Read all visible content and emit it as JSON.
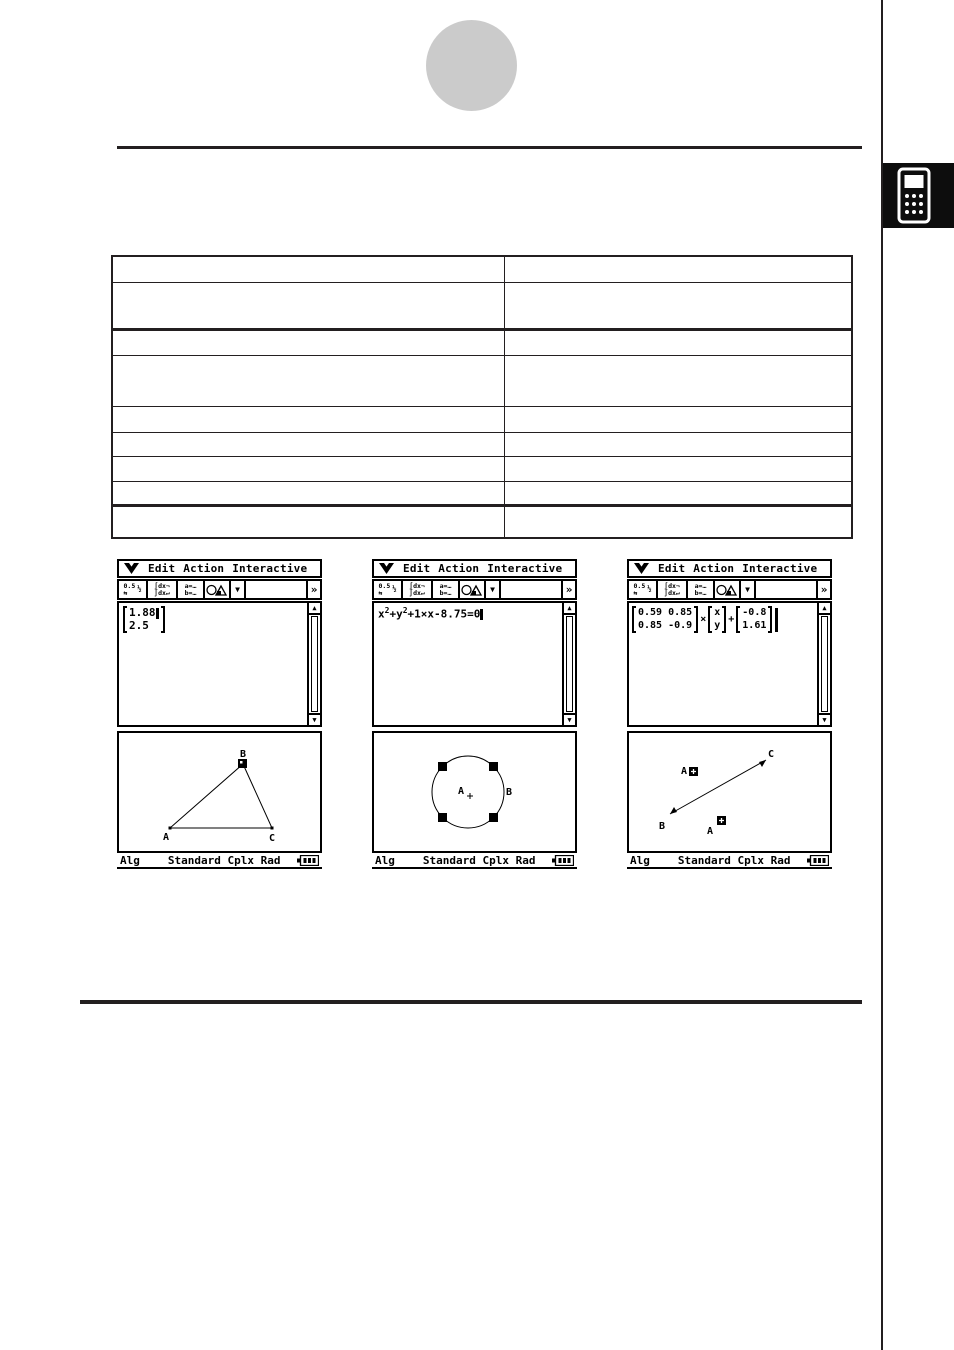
{
  "page": {
    "ink_color": "#231f20",
    "gray_circle_color": "#cbcbcb",
    "tab_color": "#0d0d0d"
  },
  "table": {
    "rows": [
      [
        "",
        ""
      ],
      [
        "",
        ""
      ],
      [
        "",
        ""
      ],
      [
        "",
        ""
      ],
      [
        "",
        ""
      ],
      [
        "",
        ""
      ],
      [
        "",
        ""
      ],
      [
        "",
        ""
      ],
      [
        "",
        ""
      ]
    ]
  },
  "chrome": {
    "menu": {
      "items": [
        "Edit",
        "Action",
        "Interactive"
      ]
    },
    "toolbar": {
      "frac_top": "0.5",
      "frac_half": "½",
      "frac_arrows": "⇆",
      "int_top": "∫dx¬",
      "int_bot": "∫dx↵",
      "ab_top": "a=…",
      "ab_bot": "b=…",
      "dropdown": "▼",
      "more": "»"
    },
    "scrollbar": {
      "up": "▲",
      "down": "▼"
    },
    "status": {
      "mode": "Alg",
      "settings": "Standard Cplx Rad"
    }
  },
  "screens": [
    {
      "entry": {
        "matrix_rows": [
          "1.88",
          "2.5"
        ]
      },
      "graph": {
        "type": "triangle",
        "labels": {
          "a": "A",
          "b": "B",
          "c": "C"
        }
      }
    },
    {
      "entry": {
        "eq_seg1": "x",
        "eq_sup1": "2",
        "eq_seg2": "+y",
        "eq_sup2": "2",
        "eq_seg3": "+1×x-8.75=0"
      },
      "graph": {
        "type": "circle",
        "labels": {
          "center": "A",
          "point": "B"
        }
      }
    },
    {
      "entry": {
        "matrix_a_rows": [
          "0.59 0.85",
          "0.85 -0.9"
        ],
        "op_mul": "×",
        "vector_rows": [
          "x",
          "y"
        ],
        "op_add": "+",
        "vector_b_rows": [
          "-0.8",
          "1.61"
        ]
      },
      "graph": {
        "type": "segment",
        "labels": {
          "a_top": "A",
          "b": "B",
          "c": "C",
          "a_bottom": "A"
        }
      }
    }
  ]
}
